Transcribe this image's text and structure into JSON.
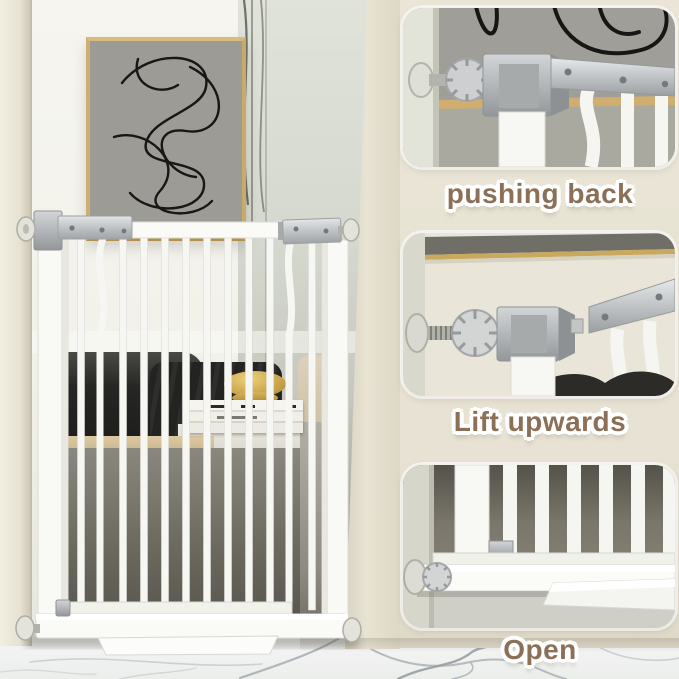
{
  "image": {
    "description": "Product photo of a white metal pressure-mounted safety gate installed in a living room, with three rounded close-up panels showing how the latch opens"
  },
  "steps": [
    {
      "caption": "pushing back"
    },
    {
      "caption": "Lift upwards"
    },
    {
      "caption": "Open"
    }
  ],
  "colors": {
    "side_background": "#e8e3d4",
    "caption_text": "#8b7057",
    "caption_outline": "#ffffff",
    "gate_white": "#f8f8f5",
    "hardware_grey": "#b5b8ba",
    "picture_frame_tan": "#c9a96c",
    "art_canvas_grey": "#9d9b96",
    "marble_floor": "#eef0ef",
    "sofa_dark": "#262624"
  }
}
